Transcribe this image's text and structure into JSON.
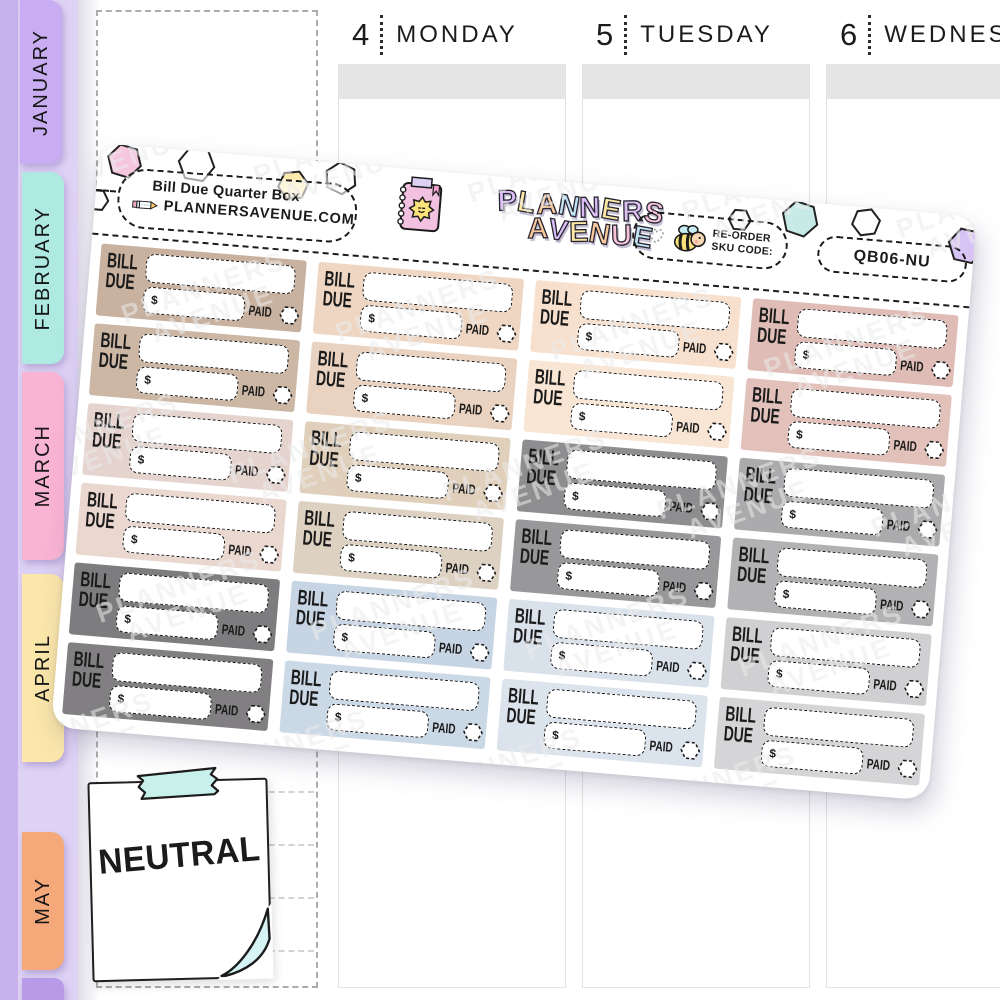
{
  "tabs": [
    {
      "label": "JANUARY",
      "color": "#c9adf2"
    },
    {
      "label": "FEBRUARY",
      "color": "#aeeae2"
    },
    {
      "label": "MARCH",
      "color": "#f9b3d3"
    },
    {
      "label": "APRIL",
      "color": "#fbe7a9"
    },
    {
      "label": "MAY",
      "color": "#f5a97a"
    }
  ],
  "next_month_tab_color": "#b79ae8",
  "calendar": {
    "days": [
      {
        "number": "4",
        "name": "MONDAY"
      },
      {
        "number": "5",
        "name": "TUESDAY"
      },
      {
        "number": "6",
        "name": "WEDNESDAY"
      }
    ]
  },
  "sheet": {
    "product_label": "Bill Due Quarter Box",
    "website": "PLANNERSAVENUE.COM",
    "logo": {
      "line1": [
        {
          "ch": "P",
          "color": "#d9bdf4"
        },
        {
          "ch": "L",
          "color": "#fce7a4"
        },
        {
          "ch": "A",
          "color": "#f9c99e"
        },
        {
          "ch": "N",
          "color": "#c2e3f4"
        },
        {
          "ch": "N",
          "color": "#d9bdf4"
        },
        {
          "ch": "E",
          "color": "#fce7a4"
        },
        {
          "ch": "R",
          "color": "#dcc0f0"
        },
        {
          "ch": "S",
          "color": "#f8c3da"
        }
      ],
      "line2": [
        {
          "ch": "A",
          "color": "#f9c99e"
        },
        {
          "ch": "V",
          "color": "#d9bdf4"
        },
        {
          "ch": "E",
          "color": "#fce7a4"
        },
        {
          "ch": "N",
          "color": "#f9c99e"
        },
        {
          "ch": "U",
          "color": "#f8c3da"
        },
        {
          "ch": "E",
          "color": "#c2e3f4"
        }
      ]
    },
    "reorder_line1": "RE-ORDER",
    "reorder_line2": "SKU CODE:",
    "sku": "QB06-NU",
    "watermark_line1": "PLANNERS",
    "watermark_line2": "AVENUE",
    "sticker_labels": {
      "bill": "BILL",
      "due": "DUE",
      "currency": "$",
      "paid": "PAID"
    },
    "sticker_colors": [
      "#c8b19f",
      "#efd6c2",
      "#f7e0cd",
      "#dfbcb6",
      "#ccb7a5",
      "#e9d2bf",
      "#f8e5d3",
      "#e2c1bb",
      "#e5d3ce",
      "#e0cfbb",
      "#8e8e90",
      "#ababad",
      "#e9d7d0",
      "#ddd2c2",
      "#98989a",
      "#b2b2b4",
      "#7d7c7e",
      "#c6d4e3",
      "#d9e1eb",
      "#d0d0d2",
      "#817f82",
      "#cbd8e6",
      "#dbe3ec",
      "#d5d5d7"
    ],
    "hexagons": [
      {
        "x": 26,
        "y": 16,
        "r": 17,
        "fill": "#f6c5de",
        "rot": 12
      },
      {
        "x": 98,
        "y": 13,
        "r": 18,
        "fill": null,
        "rot": 5
      },
      {
        "x": 196,
        "y": 26,
        "r": 15,
        "fill": "#fce9ab",
        "rot": -10
      },
      {
        "x": 243,
        "y": 15,
        "r": 16,
        "fill": null,
        "rot": 22
      },
      {
        "x": 2,
        "y": 57,
        "r": 11,
        "fill": null,
        "rot": 0
      },
      {
        "x": 644,
        "y": 23,
        "r": 11,
        "fill": null,
        "rot": 0
      },
      {
        "x": 704,
        "y": 17,
        "r": 18,
        "fill": "#c6ebe6",
        "rot": 14
      },
      {
        "x": 770,
        "y": 15,
        "r": 14,
        "fill": null,
        "rot": -12
      },
      {
        "x": 872,
        "y": 30,
        "r": 18,
        "fill": "#d8c4f4",
        "rot": 8
      }
    ]
  },
  "note": {
    "label": "NEUTRAL",
    "tape_color": "#c9f1ec",
    "fold_color": "#d6f4f6"
  }
}
